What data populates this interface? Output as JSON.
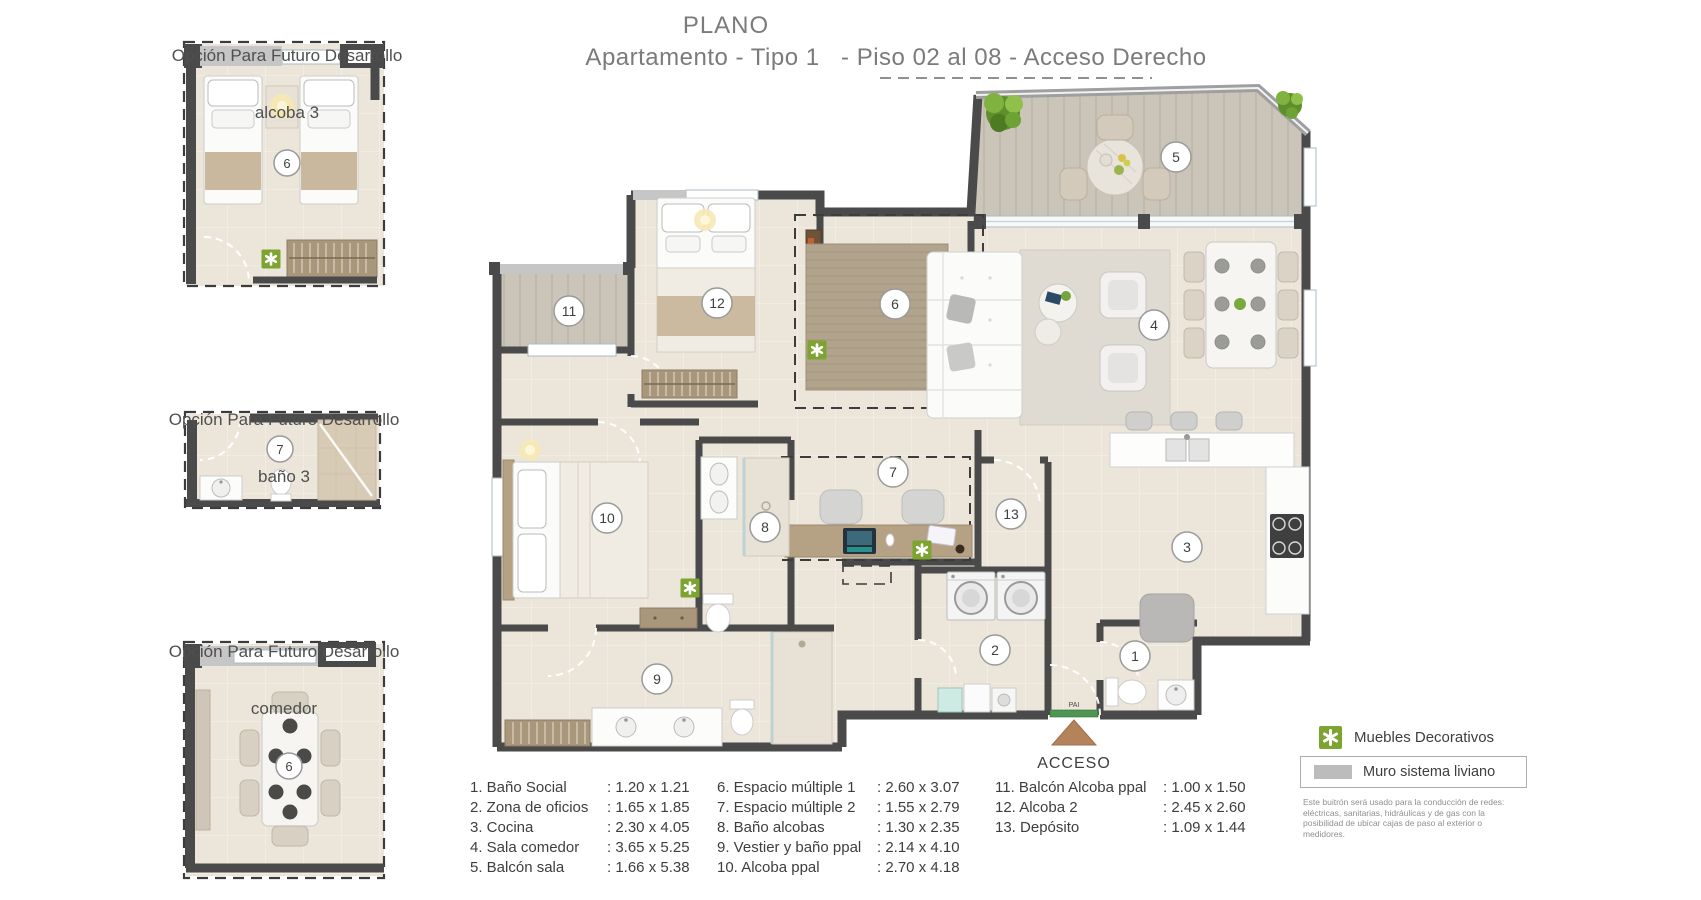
{
  "header": {
    "title": "PLANO",
    "subtitle": "Apartamento - Tipo 1   - Piso 02 al 08 - Acceso Derecho"
  },
  "options": [
    {
      "line1": "Opción Para Futuro Desarrollo",
      "line2": "alcoba 3"
    },
    {
      "line1": "Opción Para Futuro Desarrollo",
      "line2": "baño 3"
    },
    {
      "line1": "Opción Para Futuro Desarrollo",
      "line2": "comedor"
    }
  ],
  "access": {
    "label": "ACCESO",
    "door_label": "PAI"
  },
  "rooms": [
    {
      "num": "1",
      "name": "Baño Social",
      "dim": ": 1.20 x 1.21",
      "cx": 1135,
      "cy": 656
    },
    {
      "num": "2",
      "name": "Zona de oficios",
      "dim": ": 1.65 x 1.85",
      "cx": 995,
      "cy": 650
    },
    {
      "num": "3",
      "name": "Cocina",
      "dim": ": 2.30 x 4.05",
      "cx": 1187,
      "cy": 547
    },
    {
      "num": "4",
      "name": "Sala comedor",
      "dim": ": 3.65 x 5.25",
      "cx": 1154,
      "cy": 325
    },
    {
      "num": "5",
      "name": "Balcón  sala",
      "dim": ": 1.66 x 5.38",
      "cx": 1176,
      "cy": 157
    },
    {
      "num": "6",
      "name": "Espacio múltiple 1",
      "dim": ": 2.60 x 3.07",
      "cx": 895,
      "cy": 304
    },
    {
      "num": "7",
      "name": "Espacio múltiple 2",
      "dim": ": 1.55 x 2.79",
      "cx": 893,
      "cy": 472
    },
    {
      "num": "8",
      "name": "Baño alcobas",
      "dim": ": 1.30 x 2.35",
      "cx": 765,
      "cy": 527
    },
    {
      "num": "9",
      "name": "Vestier y baño ppal",
      "dim": ": 2.14 x 4.10",
      "cx": 657,
      "cy": 679
    },
    {
      "num": "10",
      "name": "Alcoba ppal",
      "dim": ": 2.70 x 4.18",
      "cx": 607,
      "cy": 518
    },
    {
      "num": "11",
      "name": "Balcón Alcoba ppal",
      "dim": ": 1.00 x 1.50",
      "cx": 569,
      "cy": 311
    },
    {
      "num": "12",
      "name": "Alcoba 2",
      "dim": ": 2.45 x 2.60",
      "cx": 717,
      "cy": 303
    },
    {
      "num": "13",
      "name": "Depósito",
      "dim": ": 1.09 x 1.44",
      "cx": 1011,
      "cy": 514
    }
  ],
  "mini_badges": [
    {
      "num": "6",
      "cx": 287,
      "cy": 163
    },
    {
      "num": "7",
      "cx": 280,
      "cy": 449
    },
    {
      "num": "6",
      "cx": 289,
      "cy": 766
    }
  ],
  "decor_markers": [
    {
      "x": 817,
      "y": 350
    },
    {
      "x": 922,
      "y": 550
    },
    {
      "x": 690,
      "y": 588
    },
    {
      "x": 271,
      "y": 259
    }
  ],
  "legend": {
    "muebles_label": "Muebles Decorativos",
    "muro_label": "Muro sistema liviano",
    "note": "Este buitrón será usado para la conducción de redes: eléctricas, sanitarias, hidráulicas y de gas con la posibilidad de ubicar cajas de paso al exterior o medidores."
  },
  "colors": {
    "accent_green": "#7da331",
    "wall_dark": "#4a4a4a",
    "wall_light": "#c6c6c6",
    "floor": "#ece5da",
    "balcony_floor": "#cbc5b9",
    "arrow": "#b5835a",
    "title_gray": "#7b7b7b"
  }
}
